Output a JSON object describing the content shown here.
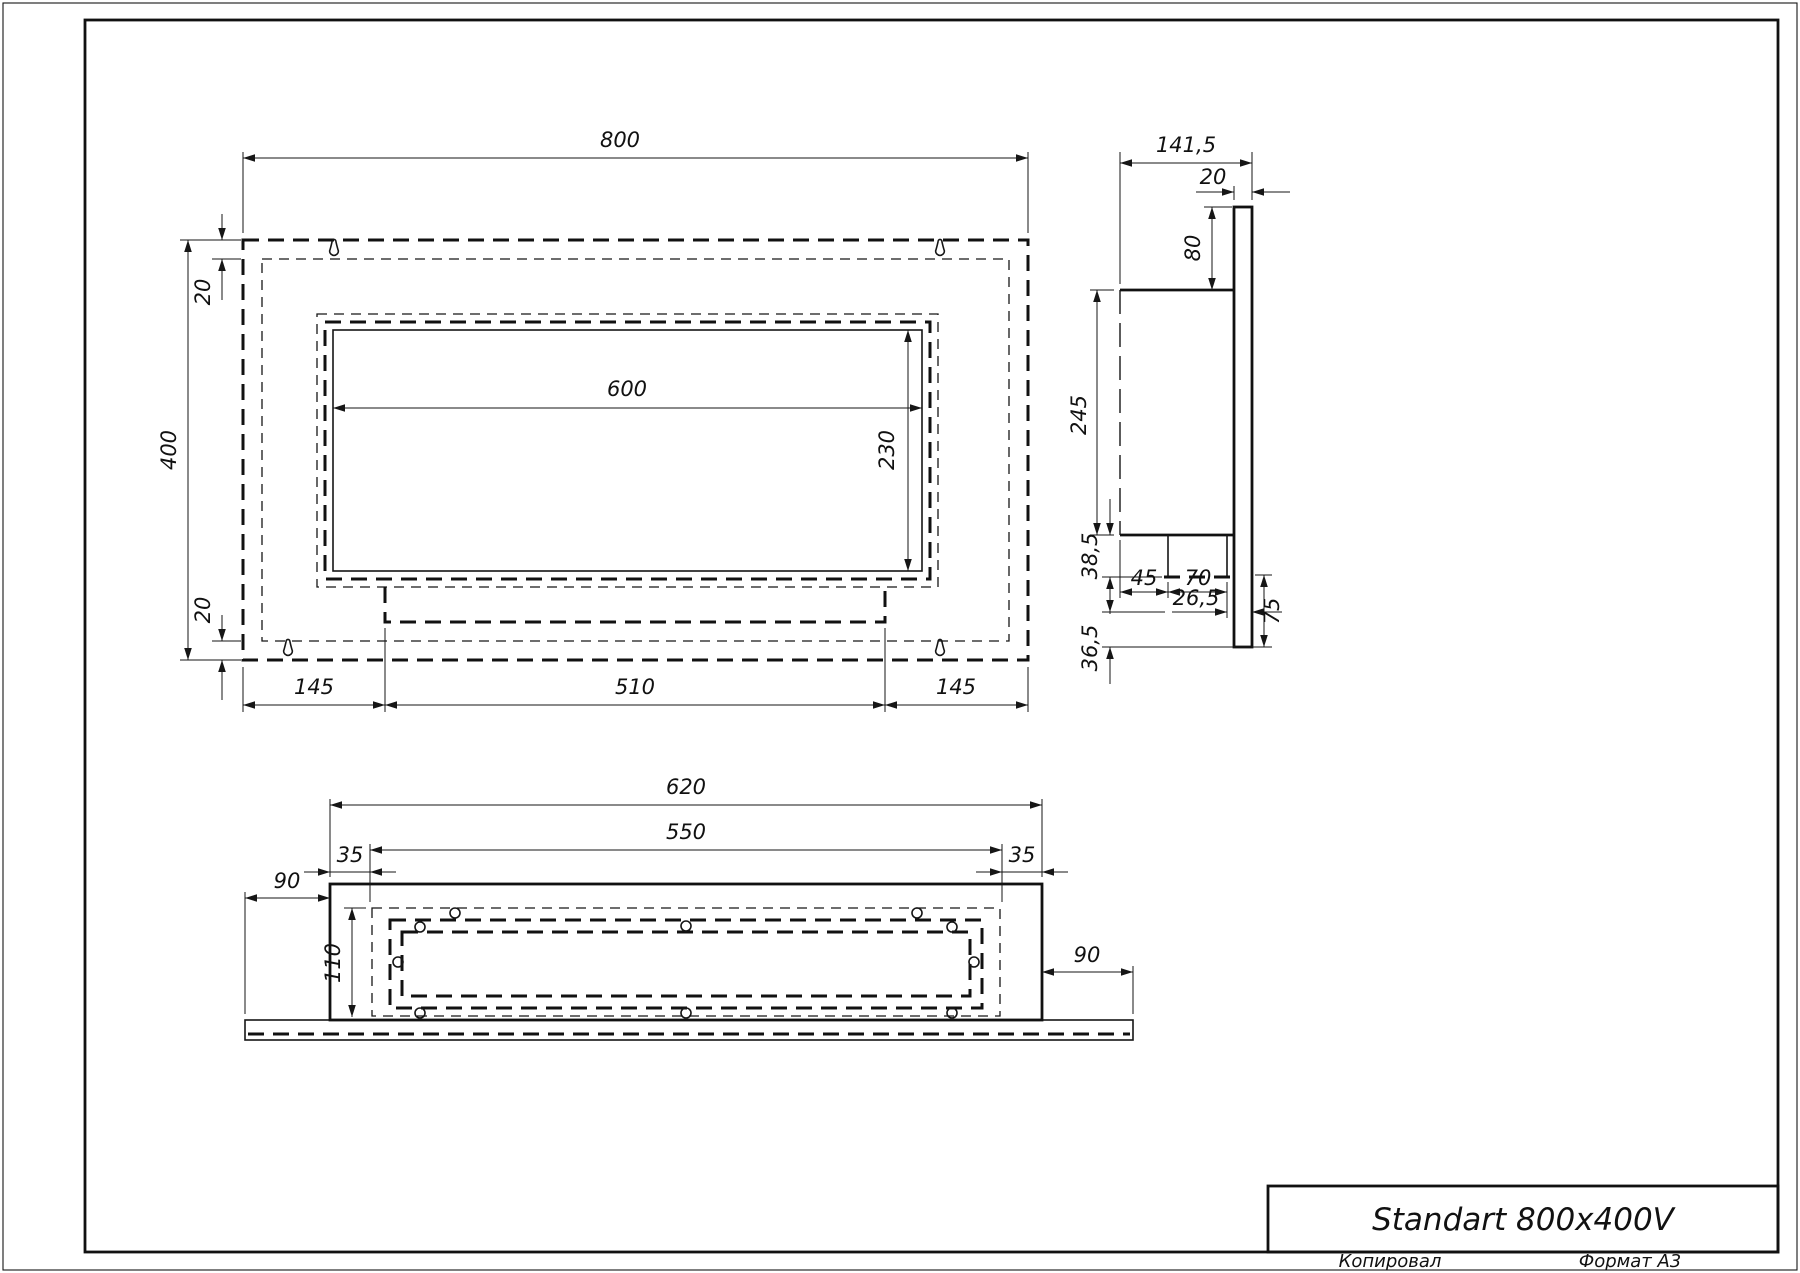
{
  "sheet": {
    "title": "Standart 800x400V",
    "copied_label": "Копировал",
    "format_label": "Формат А3"
  },
  "front_view": {
    "width": "800",
    "height": "400",
    "top_inset": "20",
    "bottom_inset": "20",
    "opening_width": "600",
    "opening_height": "230",
    "left_offset": "145",
    "tank_width": "510",
    "right_offset": "145"
  },
  "side_view": {
    "depth": "141,5",
    "plate_thickness": "20",
    "top_offset": "80",
    "body_height": "245",
    "burner_drop": "38,5",
    "front_gap": "45",
    "burner_width": "70",
    "plate_lower_height": "75",
    "back_gap": "26,5",
    "bottom_drop": "36,5"
  },
  "bottom_view": {
    "box_width": "620",
    "opening_width": "550",
    "left_inset": "35",
    "right_inset": "35",
    "left_overhang": "90",
    "right_overhang": "90",
    "depth": "110"
  }
}
